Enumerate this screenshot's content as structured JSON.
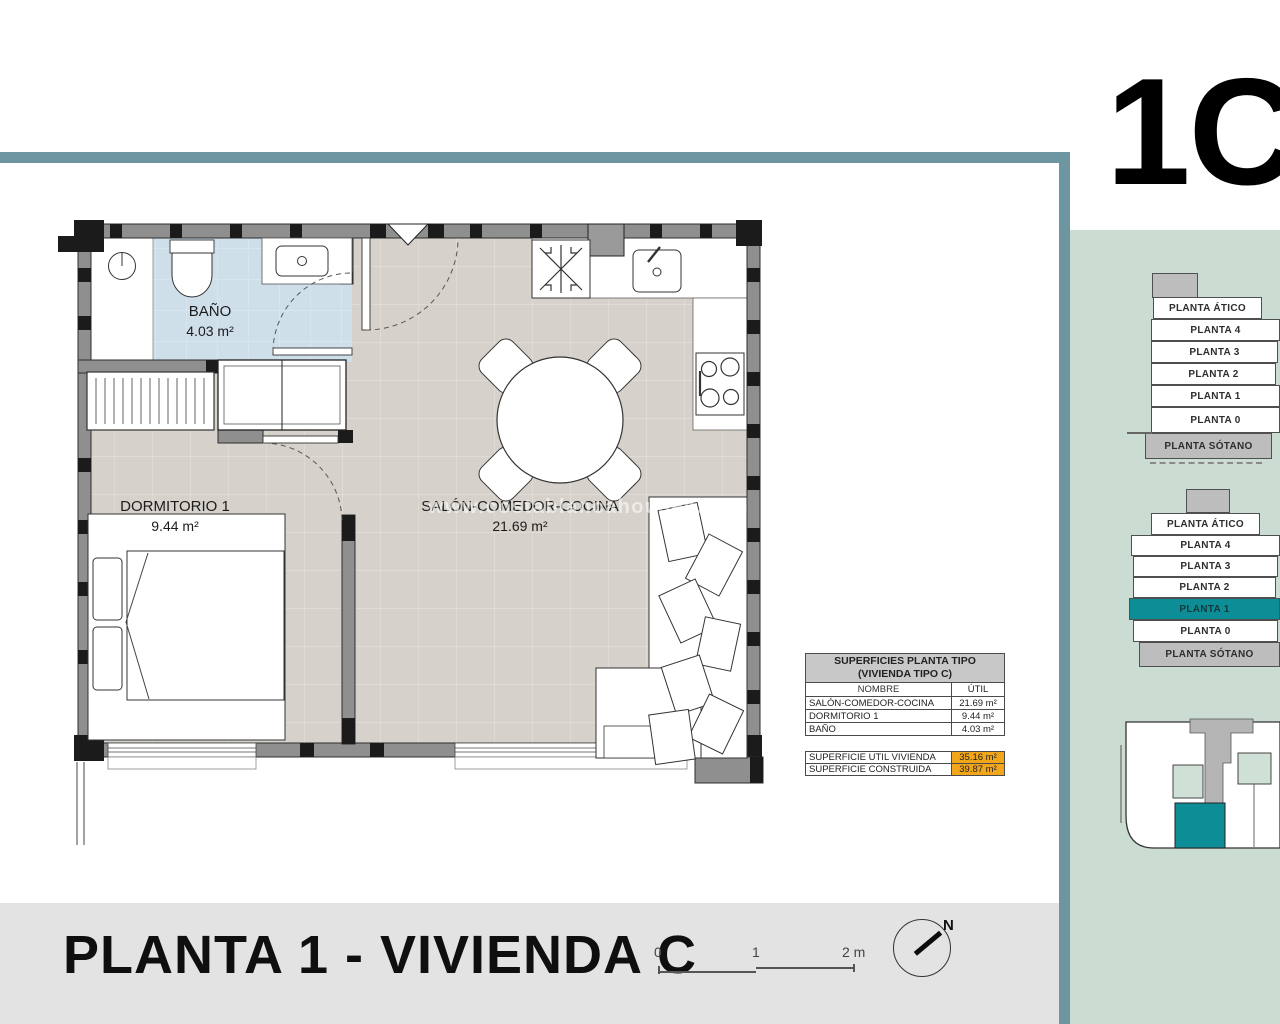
{
  "page": {
    "unit_code": "1C",
    "title": "PLANTA 1 - VIVIENDA C",
    "watermark": "www.costablancahouses.com"
  },
  "plan": {
    "rooms": [
      {
        "name": "BAÑO",
        "area": "4.03 m²"
      },
      {
        "name": "DORMITORIO 1",
        "area": "9.44 m²"
      },
      {
        "name": "SALÓN-COMEDOR-COCINA",
        "area": "21.69 m²"
      }
    ]
  },
  "surfaces_table": {
    "title_line1": "SUPERFICIES PLANTA TIPO",
    "title_line2": "(VIVIENDA TIPO C)",
    "col_name": "NOMBRE",
    "col_util": "ÚTIL",
    "rows": [
      {
        "name": "SALÓN-COMEDOR-COCINA",
        "util": "21.69 m²"
      },
      {
        "name": "DORMITORIO 1",
        "util": "9.44 m²"
      },
      {
        "name": "BAÑO",
        "util": "4.03 m²"
      }
    ],
    "totals": [
      {
        "name": "SUPERFICIE UTIL VIVIENDA",
        "value": "35.16 m²"
      },
      {
        "name": "SUPERFICIE CONSTRUIDA",
        "value": "39.87 m²"
      }
    ]
  },
  "floor_selector": {
    "floors": [
      "PLANTA ÁTICO",
      "PLANTA 4",
      "PLANTA 3",
      "PLANTA 2",
      "PLANTA 1",
      "PLANTA 0",
      "PLANTA SÓTANO"
    ],
    "selected": "PLANTA 1"
  },
  "scale_bar": {
    "start": "0",
    "middle": "1",
    "end": "2 m"
  },
  "compass": {
    "north": "N"
  },
  "colors": {
    "accent_teal_bar": "#6E96A2",
    "panel_green": "#CBDCD3",
    "selected_teal": "#0D8E96",
    "highlight_orange": "#F2A71B",
    "bathroom_blue": "#CFDFEA",
    "floor_gray": "#D6D2CB",
    "title_band_gray": "#E3E3E3"
  }
}
